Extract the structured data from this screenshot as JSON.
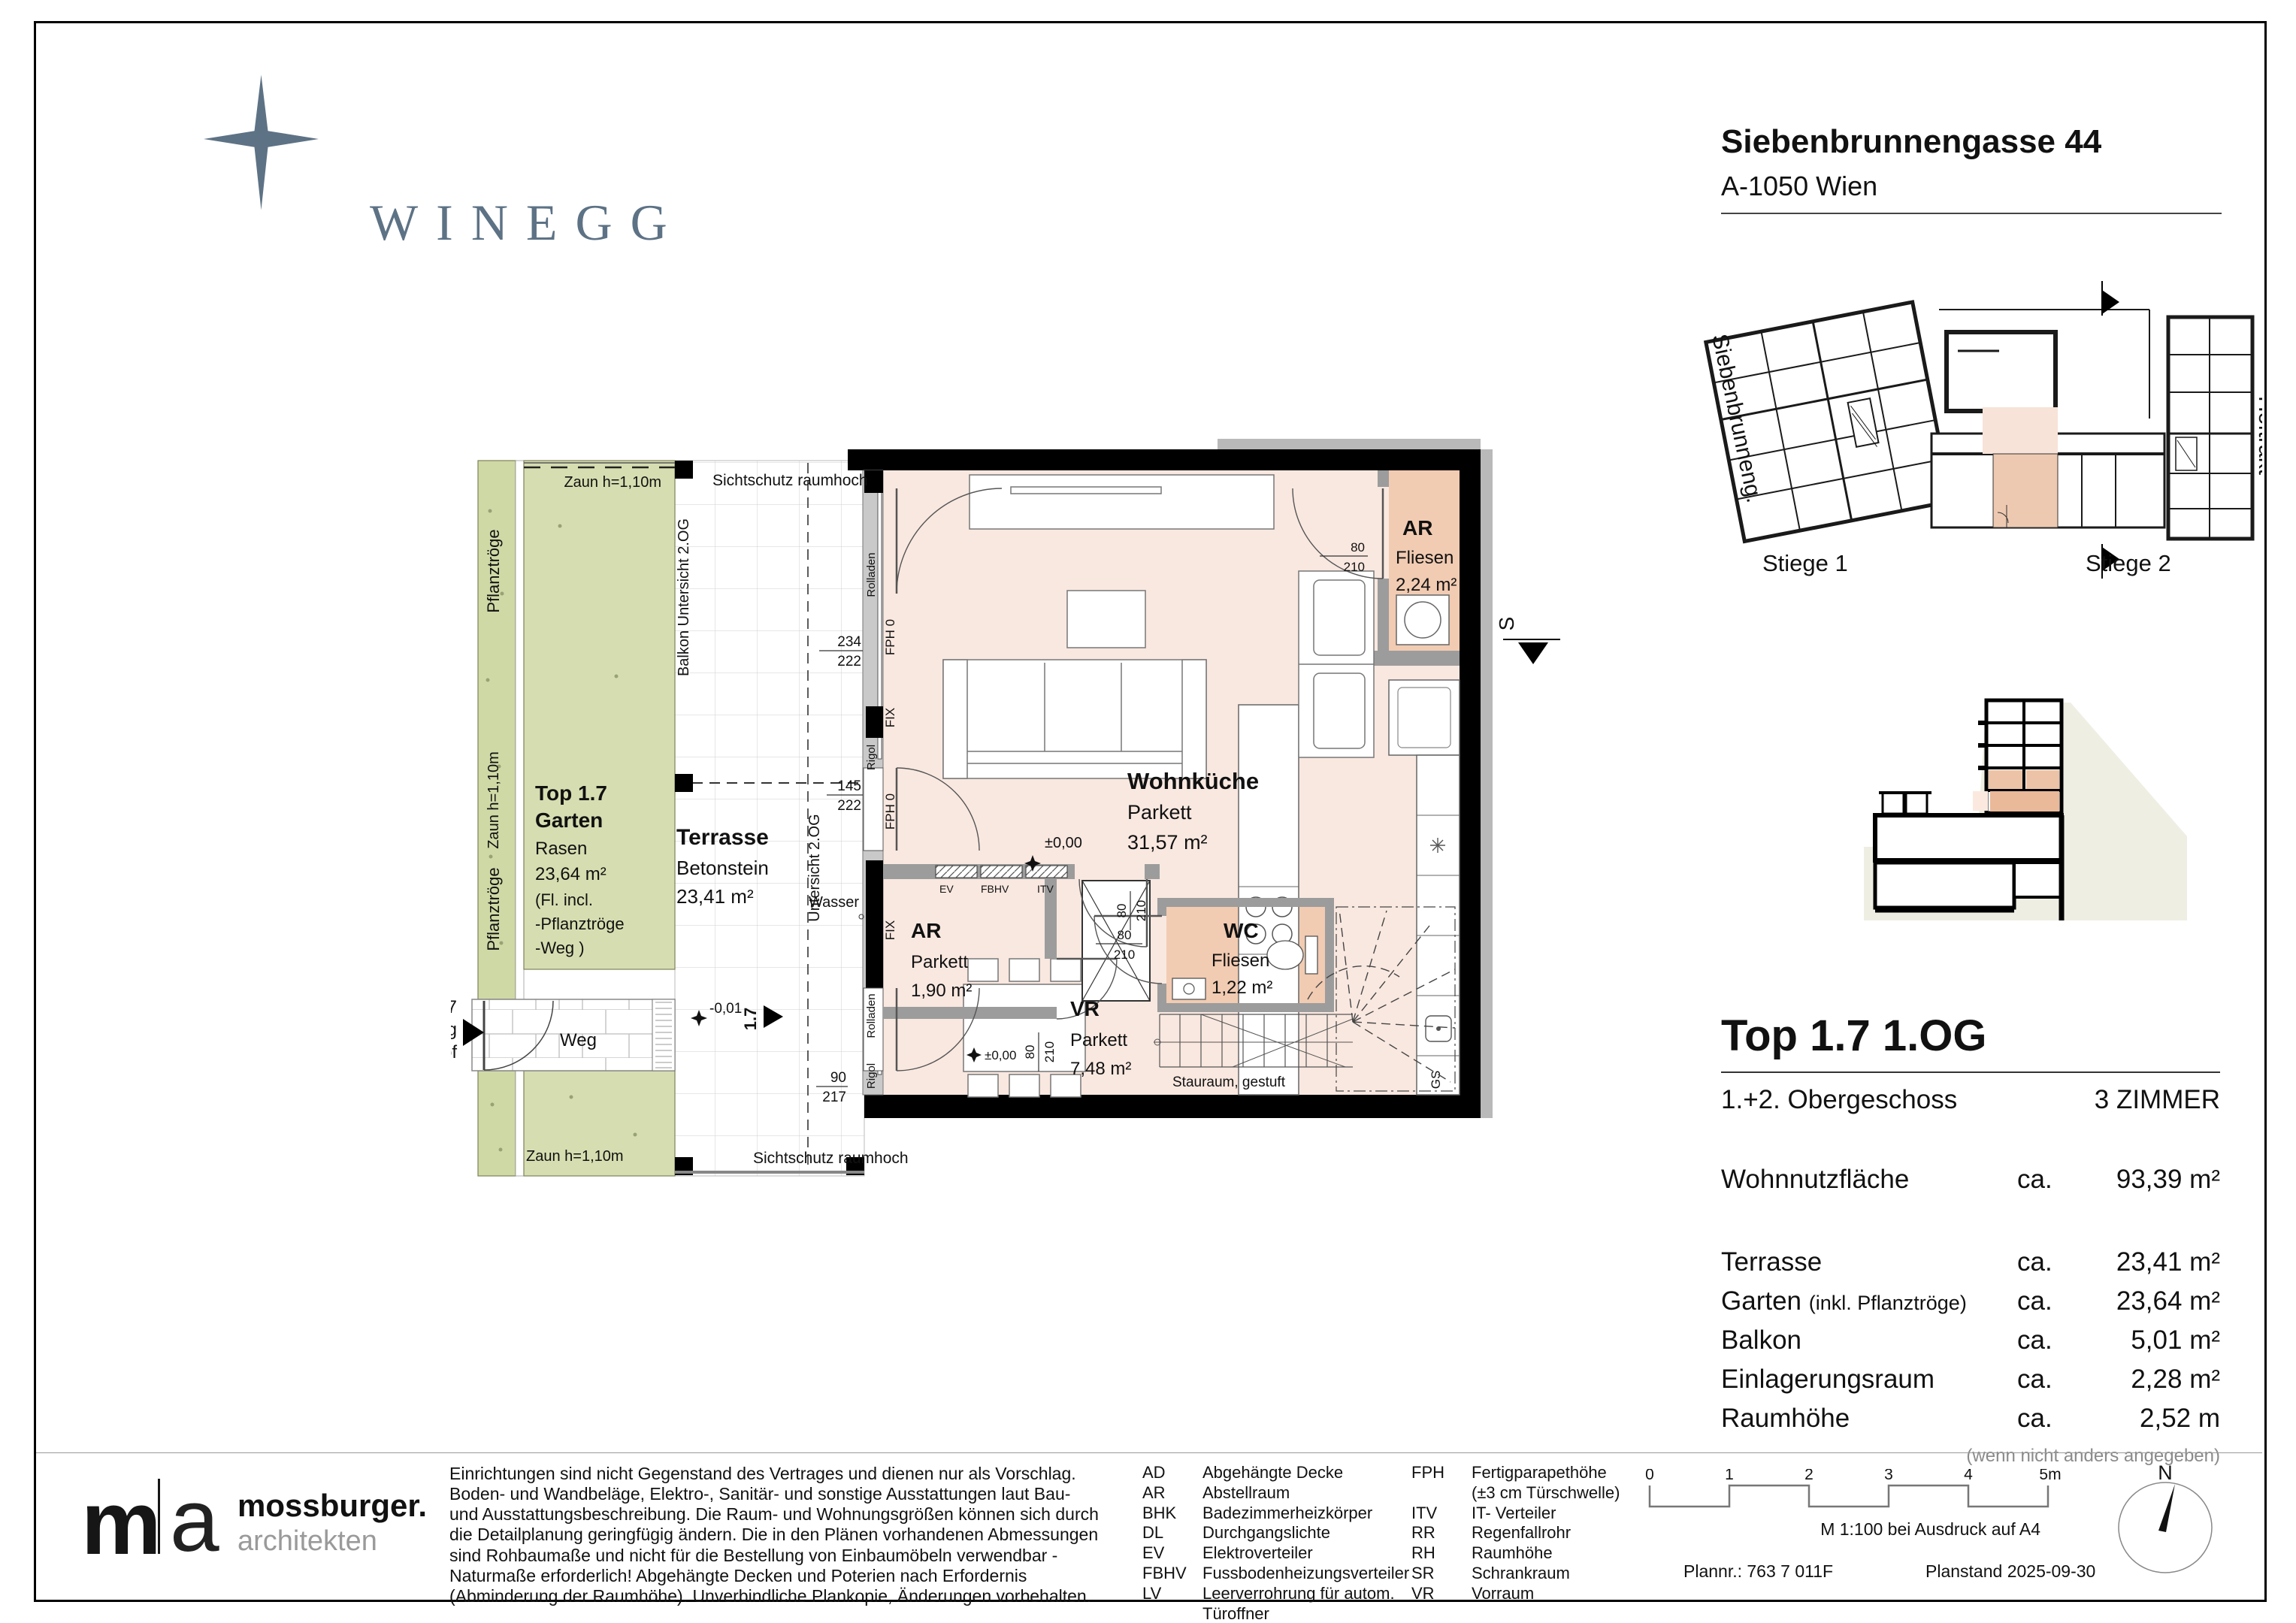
{
  "header": {
    "brand": "WINEGG",
    "address_line1": "Siebenbrunnengasse 44",
    "address_line2": "A-1050 Wien"
  },
  "site_plan": {
    "street": "Siebenbrunneng.",
    "hoftrakt": "Hoftrakt",
    "stiege1": "Stiege 1",
    "stiege2": "Stiege 2"
  },
  "plan": {
    "zaun": "Zaun h=1,10m",
    "pflanztroege": "Pflanztröge",
    "sichtschutz": "Sichtschutz raumhoch",
    "balkon_untersicht": "Balkon Untersicht 2.OG",
    "untersicht": "Untersicht 2.OG",
    "garten_top": "Top 1.7",
    "garten": "Garten",
    "rasen": "Rasen",
    "garten_area": "23,64 m²",
    "garten_note1": "(Fl. incl.",
    "garten_note2": "-Pflanztröge",
    "garten_note3": "-Weg )",
    "terrasse": "Terrasse",
    "betonstein": "Betonstein",
    "terrasse_area": "23,41 m²",
    "wasser": "Wasser",
    "weg": "Weg",
    "zugang1": "Top 1.7",
    "zugang2": "Zugang",
    "zugang3": "von Innenhof",
    "level_zero": "±0,00",
    "level_minus": "-0,01",
    "unit_no": "1.7",
    "wohnkueche": "Wohnküche",
    "parkett": "Parkett",
    "wohnkueche_area": "31,57 m²",
    "ar": "AR",
    "fliesen": "Fliesen",
    "ar_area_upper": "2,24 m²",
    "ar_area_lower": "1,90 m²",
    "wc": "WC",
    "wc_area": "1,22 m²",
    "vr": "VR",
    "vr_area": "7,48 m²",
    "stauraum": "Stauraum, gestuft",
    "ev": "EV",
    "fbhv": "FBHV",
    "itv": "ITV",
    "fix": "FIX",
    "fph0": "FPH 0",
    "rolladen": "Rolladen",
    "rigol": "Rigol",
    "gs": "GS",
    "s": "S",
    "d234": "234",
    "d222": "222",
    "d145": "145",
    "d90": "90",
    "d217": "217",
    "d80": "80",
    "d210": "210"
  },
  "info": {
    "title": "Top 1.7 1.OG",
    "floor": "1.+2. Obergeschoss",
    "rooms": "3 ZIMMER",
    "ca": "ca.",
    "main_label": "Wohnnutzfläche",
    "main_value": "93,39 m²",
    "rows": [
      {
        "label": "Terrasse",
        "small": "",
        "value": "23,41 m²"
      },
      {
        "label": "Garten",
        "small": "(inkl. Pflanztröge)",
        "value": "23,64 m²"
      },
      {
        "label": "Balkon",
        "small": "",
        "value": "5,01 m²"
      },
      {
        "label": "Einlagerungsraum",
        "small": "",
        "value": "2,28 m²"
      },
      {
        "label": "Raumhöhe",
        "small": "",
        "value": "2,52 m"
      }
    ],
    "note": "(wenn nicht anders angegeben)"
  },
  "legend": {
    "left": [
      {
        "code": "AD",
        "desc": "Abgehängte Decke"
      },
      {
        "code": "AR",
        "desc": "Abstellraum"
      },
      {
        "code": "BHK",
        "desc": "Badezimmerheizkörper"
      },
      {
        "code": "DL",
        "desc": "Durchgangslichte"
      },
      {
        "code": "EV",
        "desc": "Elektroverteiler"
      },
      {
        "code": "FBHV",
        "desc": "Fussbodenheizungsverteiler"
      },
      {
        "code": "LV",
        "desc": "Leerverrohrung für autom. Türoffner"
      }
    ],
    "right": [
      {
        "code": "FPH",
        "desc": "Fertigparapethöhe"
      },
      {
        "code": "",
        "desc": "(±3 cm Türschwelle)"
      },
      {
        "code": "ITV",
        "desc": "IT- Verteiler"
      },
      {
        "code": "RR",
        "desc": "Regenfallrohr"
      },
      {
        "code": "RH",
        "desc": "Raumhöhe"
      },
      {
        "code": "SR",
        "desc": "Schrankraum"
      },
      {
        "code": "VR",
        "desc": "Vorraum"
      }
    ]
  },
  "disclaimer": "Einrichtungen sind nicht Gegenstand des Vertrages und dienen nur als Vorschlag. Boden- und Wandbeläge, Elektro-, Sanitär- und sonstige Ausstattungen laut Bau- und Ausstattungsbeschreibung. Die Raum- und Wohnungsgrößen können sich durch die Detailplanung geringfügig ändern. Die in den Plänen vorhandenen Abmessungen sind Rohbaumaße und nicht für die Bestellung von Einbaumöbeln verwendbar - Naturmaße erforderlich! Abgehängte Decken und Poterien nach Erfordernis (Abminderung der Raumhöhe). Unverbindliche Plankopie, Änderungen vorbehalten.",
  "architect": {
    "m": "m",
    "a": "a",
    "name": "mossburger.",
    "subtitle": "architekten"
  },
  "footer": {
    "ticks": [
      "0",
      "1",
      "2",
      "3",
      "4",
      "5m"
    ],
    "scale_note": "M 1:100 bei Ausdruck auf A4",
    "plan_number": "Plannr.: 763 7 011F",
    "plan_date": "Planstand 2025-09-30",
    "north": "N"
  },
  "colors": {
    "brand_slate": "#5d7285",
    "interior_peach": "#f9e8e0",
    "room_peach": "#f1cbb2",
    "garden_green": "#d6deb1",
    "strip_green": "#cfd9a6",
    "wall_gray": "#9c9c9c",
    "section_beige": "#efeee3"
  }
}
